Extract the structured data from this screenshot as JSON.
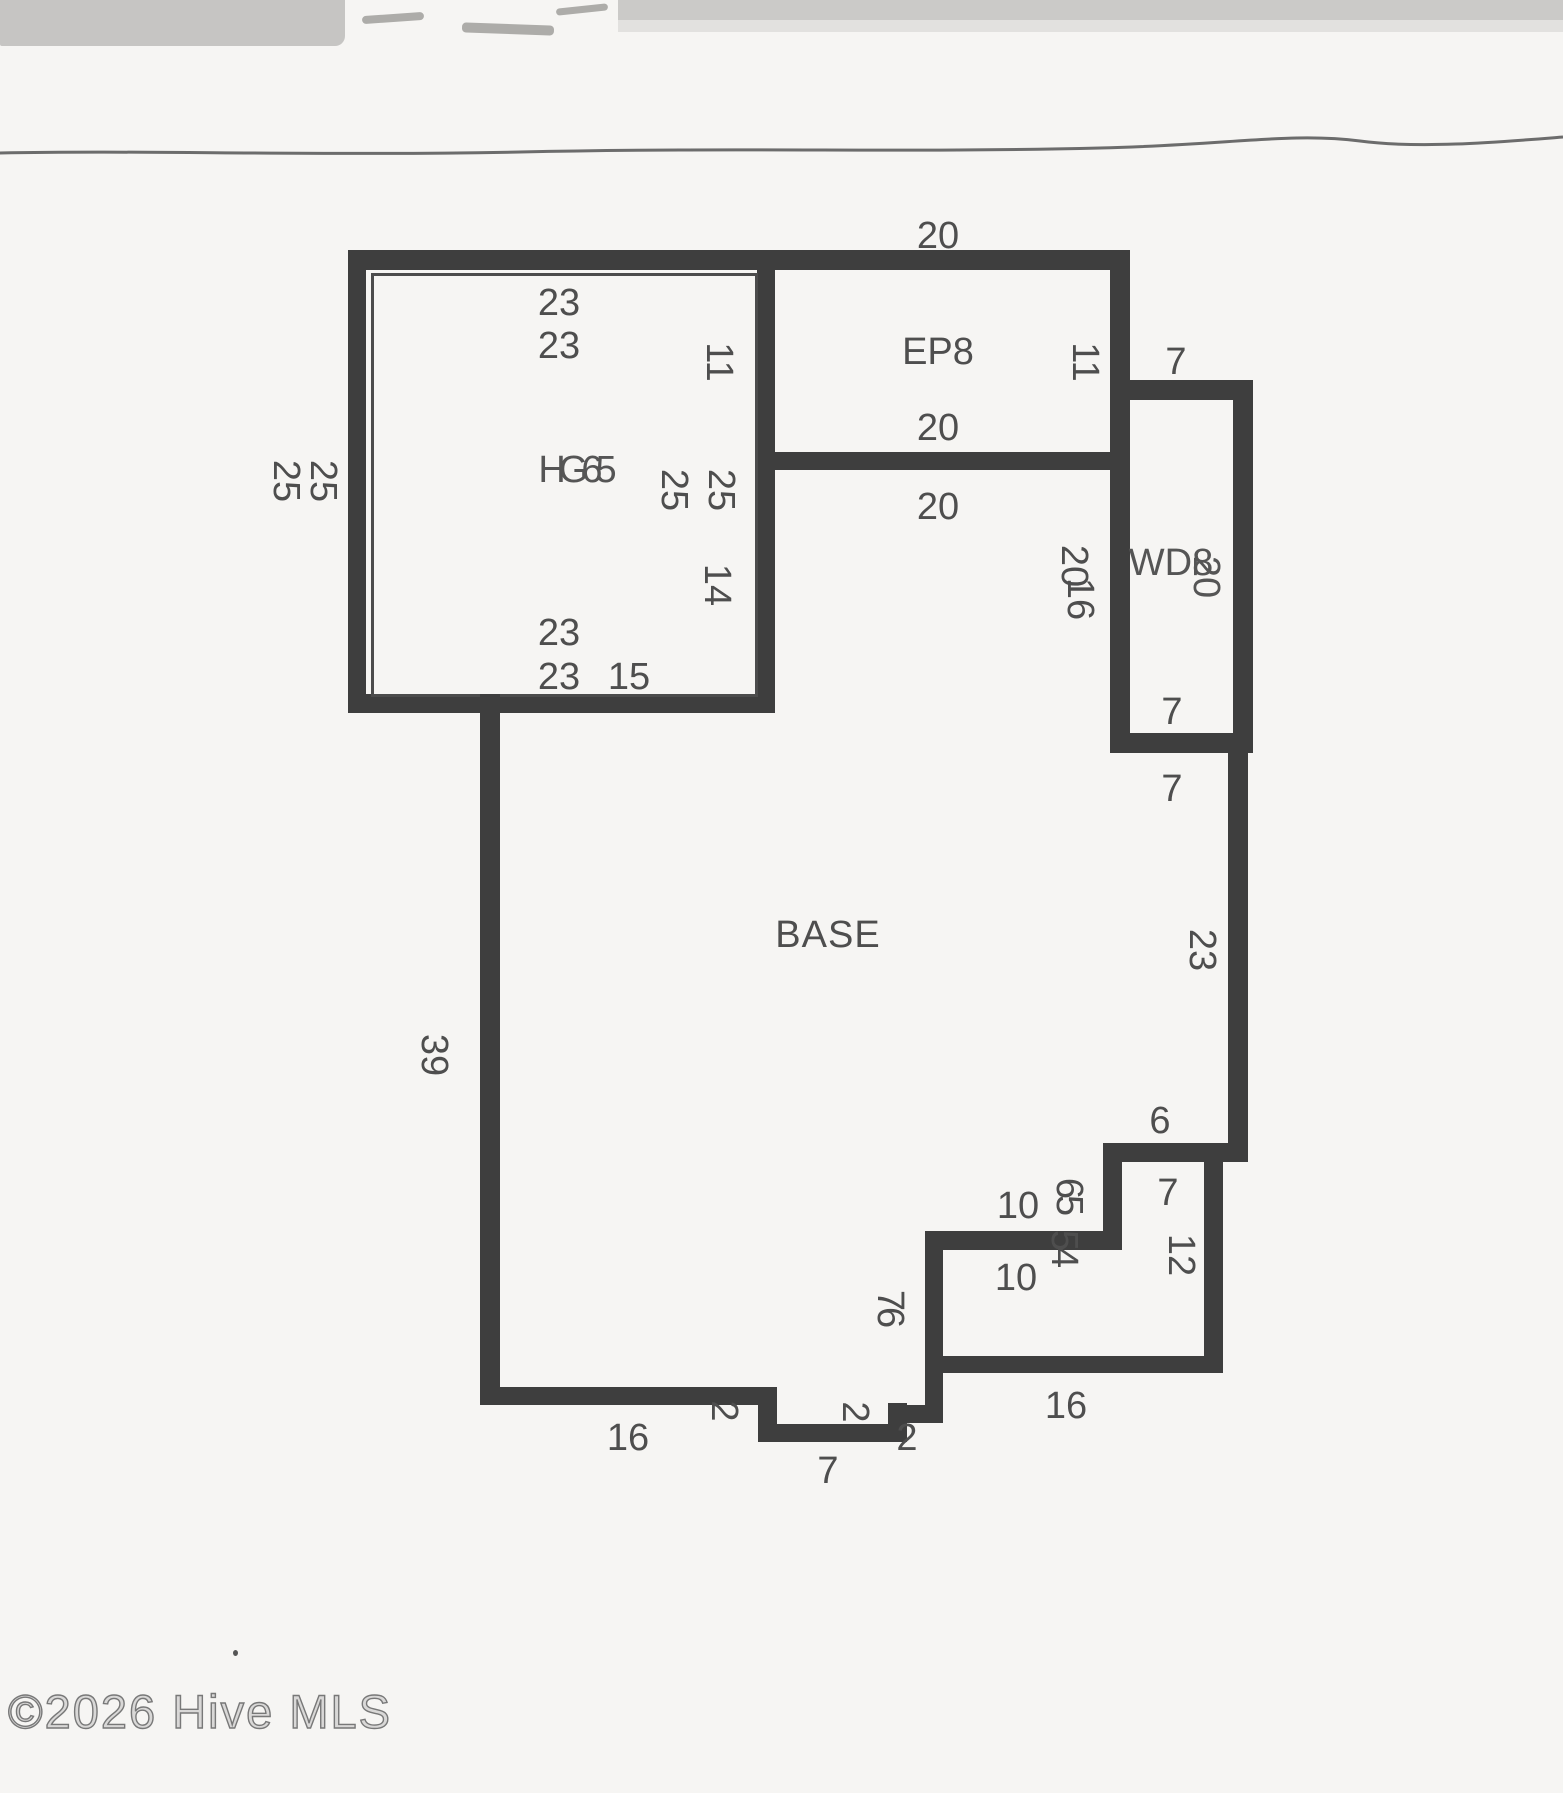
{
  "scan": {
    "watermark": "©2026 Hive MLS"
  },
  "plan": {
    "area_labels": {
      "base": "BASE",
      "enclosed_porch": "EP8",
      "wood_deck": "WD8",
      "garage": "HG65"
    },
    "labels": {
      "ep8_top_20": "20",
      "ep8_inner_20": "20",
      "base_upper_20": "20",
      "gar_top_23a": "23",
      "gar_top_23b": "23",
      "gar_bottom_23a": "23",
      "gar_bottom_23b": "23",
      "gar_bottom_15": "15",
      "gar_left_25a": "25",
      "gar_left_25b": "25",
      "gar_right_25a": "25",
      "gar_right_25b": "25",
      "gar_right_11": "11",
      "gar_right_14": "14",
      "ep8_right_11": "11",
      "wd_top_7": "7",
      "wd_inner_7": "7",
      "wd_below_7": "7",
      "wd_side_20": "20",
      "wd_side_16": "16",
      "wd_label_20": "20",
      "right_23": "23",
      "left_39": "39",
      "step_6": "6",
      "deck_7": "7",
      "deck_10a": "10",
      "deck_10b": "10",
      "deck_12": "12",
      "deck_16": "16",
      "deck_65": "65",
      "deck_54": "54",
      "deck_76": "76",
      "base_bottom_16": "16",
      "notch_7": "7",
      "notch_2a": "2",
      "notch_2b": "2",
      "notch_2c": "2"
    }
  }
}
